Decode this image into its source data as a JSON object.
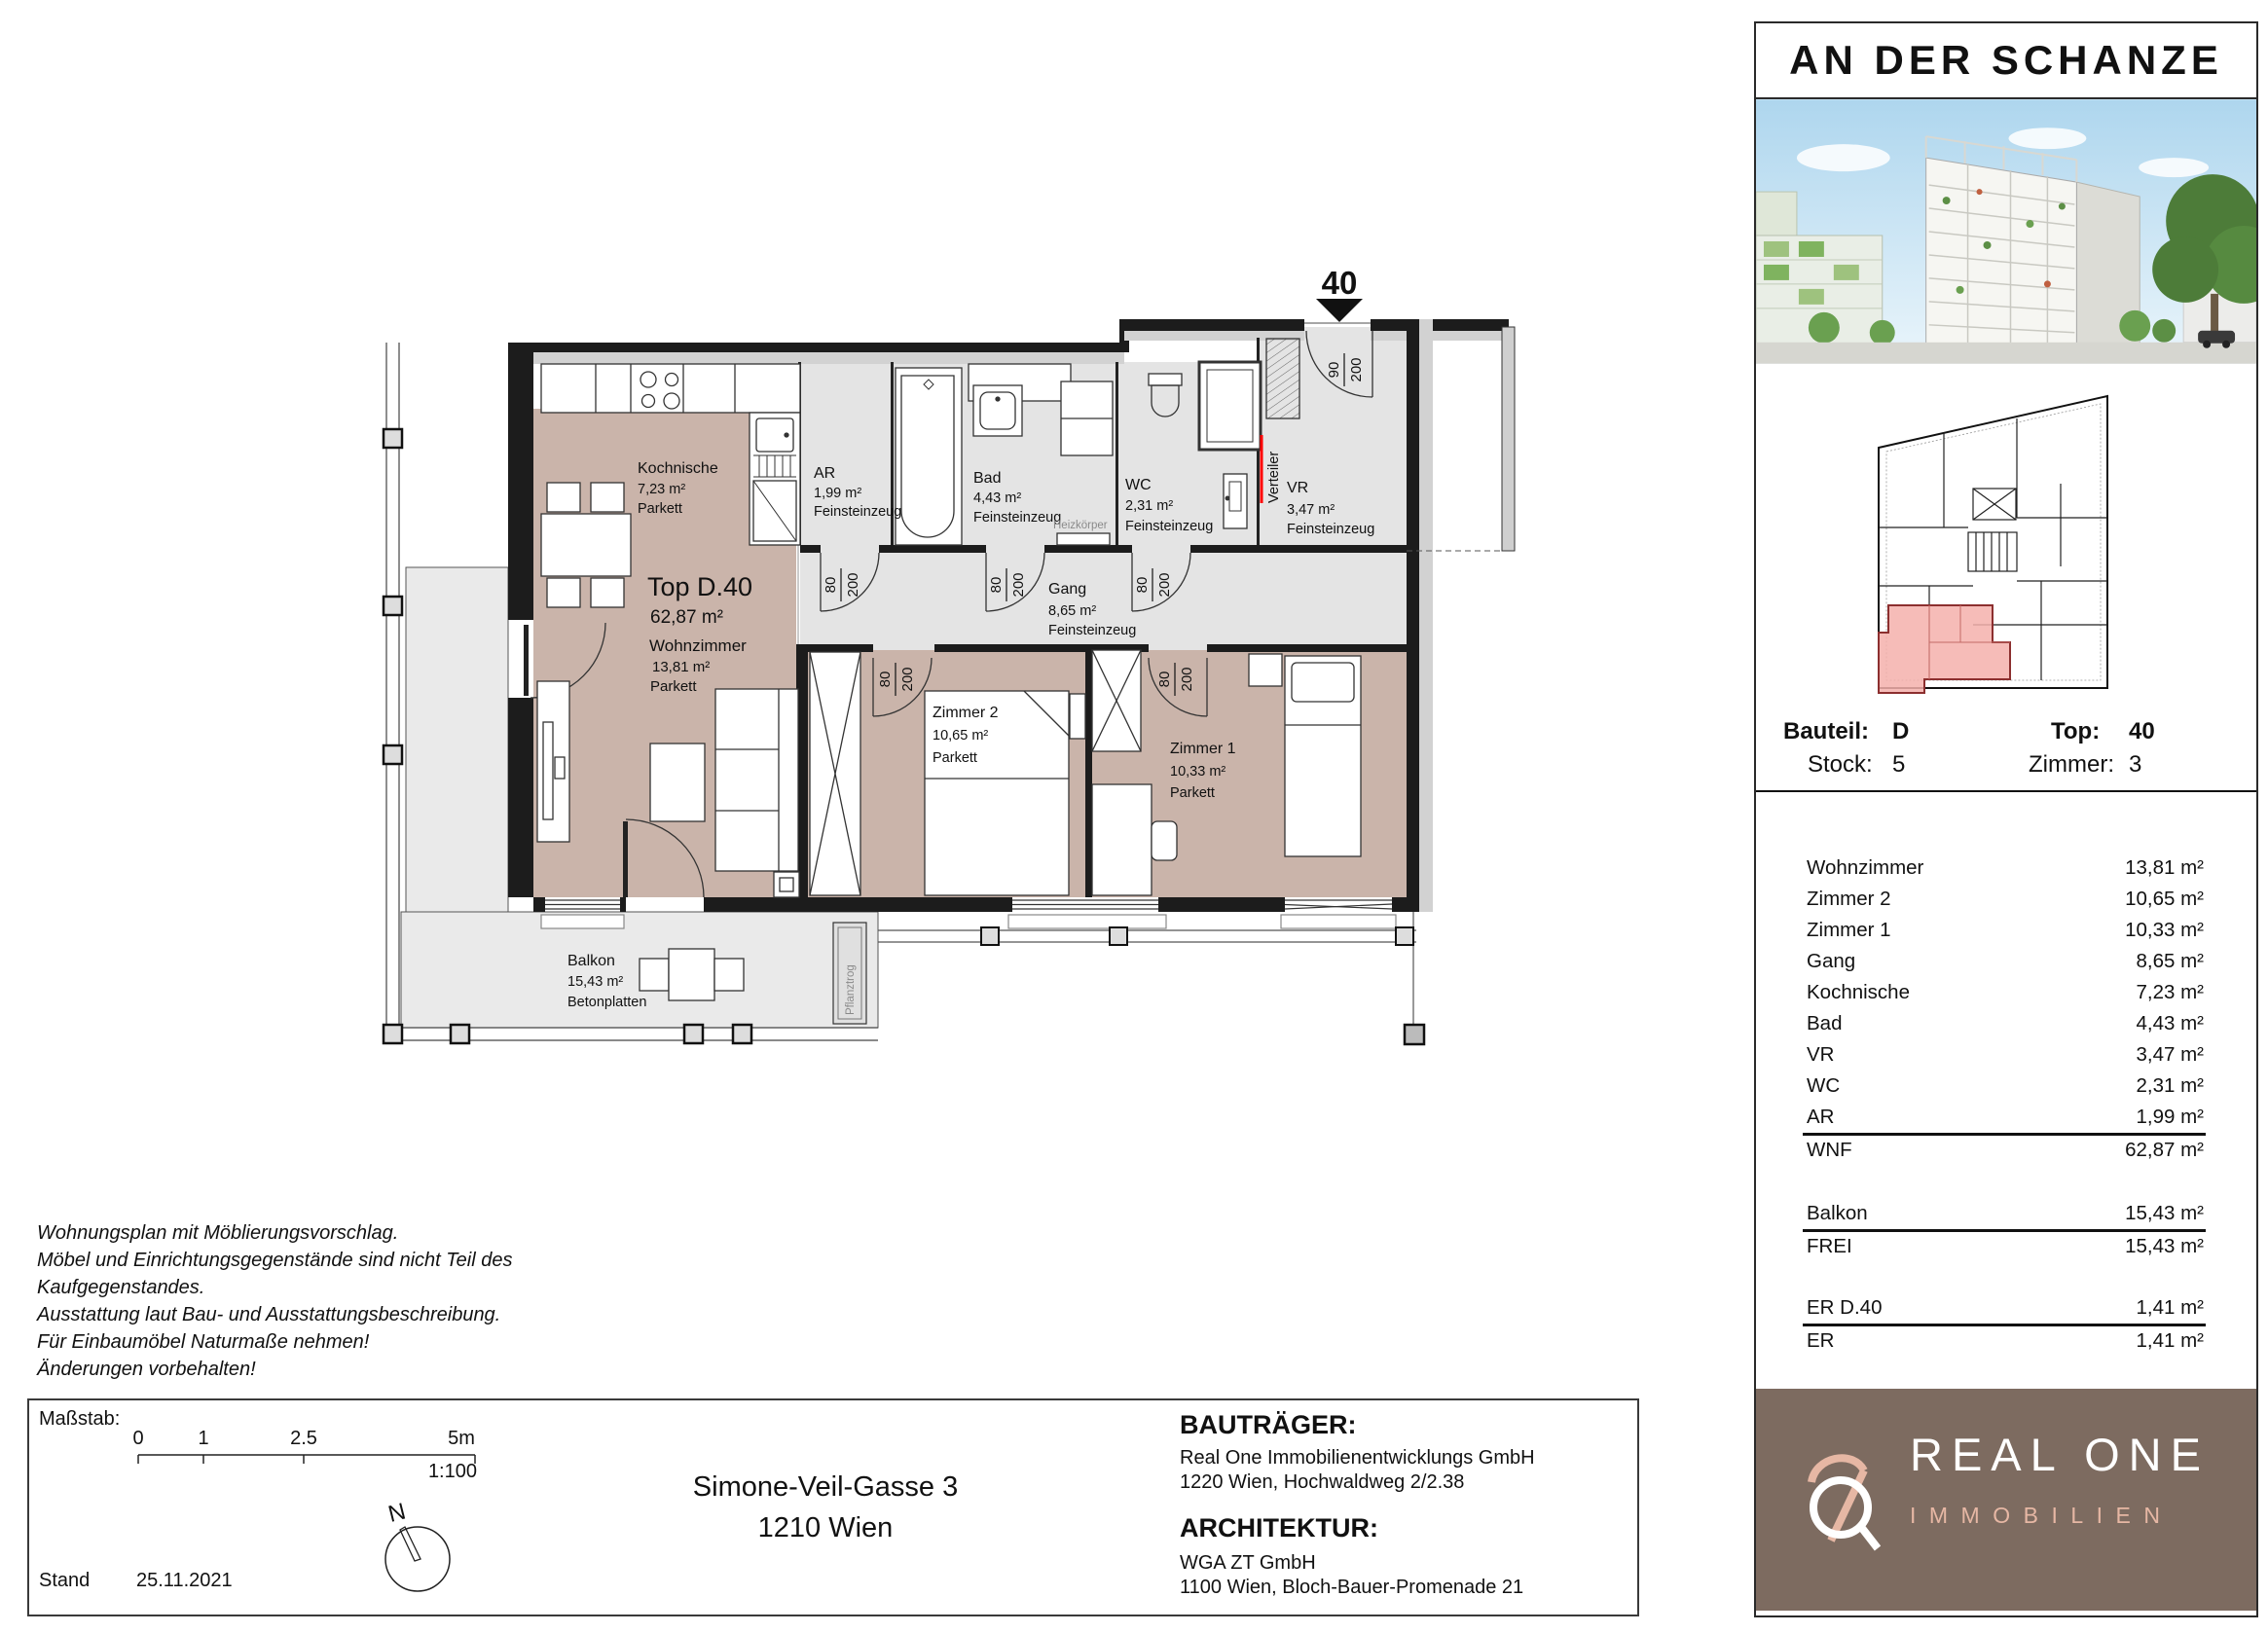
{
  "project": {
    "title": "AN DER SCHANZE"
  },
  "plan": {
    "unit_marker": "40",
    "unit_title": "Top D.40",
    "unit_area": "62,87 m²",
    "rooms": {
      "kochnische": {
        "name": "Kochnische",
        "area": "7,23 m²",
        "floor": "Parkett"
      },
      "wohnzimmer": {
        "name": "Wohnzimmer",
        "area": "13,81 m²",
        "floor": "Parkett"
      },
      "ar": {
        "name": "AR",
        "area": "1,99 m²",
        "floor": "Feinsteinzeug"
      },
      "bad": {
        "name": "Bad",
        "area": "4,43 m²",
        "floor": "Feinsteinzeug"
      },
      "wc": {
        "name": "WC",
        "area": "2,31 m²",
        "floor": "Feinsteinzeug"
      },
      "vr": {
        "name": "VR",
        "area": "3,47 m²",
        "floor": "Feinsteinzeug"
      },
      "gang": {
        "name": "Gang",
        "area": "8,65 m²",
        "floor": "Feinsteinzeug"
      },
      "zimmer2": {
        "name": "Zimmer 2",
        "area": "10,65 m²",
        "floor": "Parkett"
      },
      "zimmer1": {
        "name": "Zimmer 1",
        "area": "10,33 m²",
        "floor": "Parkett"
      },
      "balkon": {
        "name": "Balkon",
        "area": "15,43 m²",
        "floor": "Betonplatten"
      }
    },
    "annotations": {
      "verteiler": "Verteiler",
      "heizkoerper": "Heizkörper",
      "pflanztrog": "Pflanztrog"
    },
    "door_labels": {
      "w80": "80",
      "w90": "90",
      "h200": "200"
    }
  },
  "sidebar": {
    "unit_info": {
      "bauteil_label": "Bauteil:",
      "bauteil_value": "D",
      "top_label": "Top:",
      "top_value": "40",
      "stock_label": "Stock:",
      "stock_value": "5",
      "zimmer_label": "Zimmer:",
      "zimmer_value": "3"
    },
    "area_table": {
      "rooms": [
        {
          "label": "Wohnzimmer",
          "value": "13,81 m²"
        },
        {
          "label": "Zimmer 2",
          "value": "10,65 m²"
        },
        {
          "label": "Zimmer 1",
          "value": "10,33 m²"
        },
        {
          "label": "Gang",
          "value": "8,65 m²"
        },
        {
          "label": "Kochnische",
          "value": "7,23 m²"
        },
        {
          "label": "Bad",
          "value": "4,43 m²"
        },
        {
          "label": "VR",
          "value": "3,47 m²"
        },
        {
          "label": "WC",
          "value": "2,31 m²"
        },
        {
          "label": "AR",
          "value": "1,99 m²"
        }
      ],
      "wnf": {
        "label": "WNF",
        "value": "62,87 m²"
      },
      "balkon": {
        "label": "Balkon",
        "value": "15,43 m²"
      },
      "frei": {
        "label": "FREI",
        "value": "15,43 m²"
      },
      "er_unit": {
        "label": "ER D.40",
        "value": "1,41 m²"
      },
      "er": {
        "label": "ER",
        "value": "1,41 m²"
      }
    },
    "logo": {
      "line1": "REAL ONE",
      "line2": "IMMOBILIEN"
    }
  },
  "notes": [
    "Wohnungsplan mit Möblierungsvorschlag.",
    "Möbel und Einrichtungsgegenstände sind nicht Teil des",
    "Kaufgegenstandes.",
    "Ausstattung laut Bau- und Ausstattungsbeschreibung.",
    "Für Einbaumöbel Naturmaße nehmen!",
    "Änderungen vorbehalten!"
  ],
  "footer": {
    "massstab_label": "Maßstab:",
    "scale_ticks": [
      "0",
      "1",
      "2.5",
      "5m"
    ],
    "scale_ratio": "1:100",
    "stand_label": "Stand",
    "stand_date": "25.11.2021",
    "north_label": "N",
    "address_line1": "Simone-Veil-Gasse 3",
    "address_line2": "1210 Wien",
    "bautraeger_label": "BAUTRÄGER:",
    "bautraeger_name": "Real One Immobilienentwicklungs GmbH",
    "bautraeger_address": "1220 Wien, Hochwaldweg 2/2.38",
    "architektur_label": "ARCHITEKTUR:",
    "architektur_name": "WGA ZT GmbH",
    "architektur_address": "1100 Wien, Bloch-Bauer-Promenade 21"
  },
  "colors": {
    "wood_floor": "#cab4aa",
    "tile_floor": "#e4e4e4",
    "balcony_floor": "#eaeaea",
    "wall": "#1c1c1c",
    "marker_red": "#ee1400",
    "unit_highlight": "#f5b0ac",
    "brand_brown": "#7d6b60",
    "brand_pink": "#e6b7a4"
  }
}
